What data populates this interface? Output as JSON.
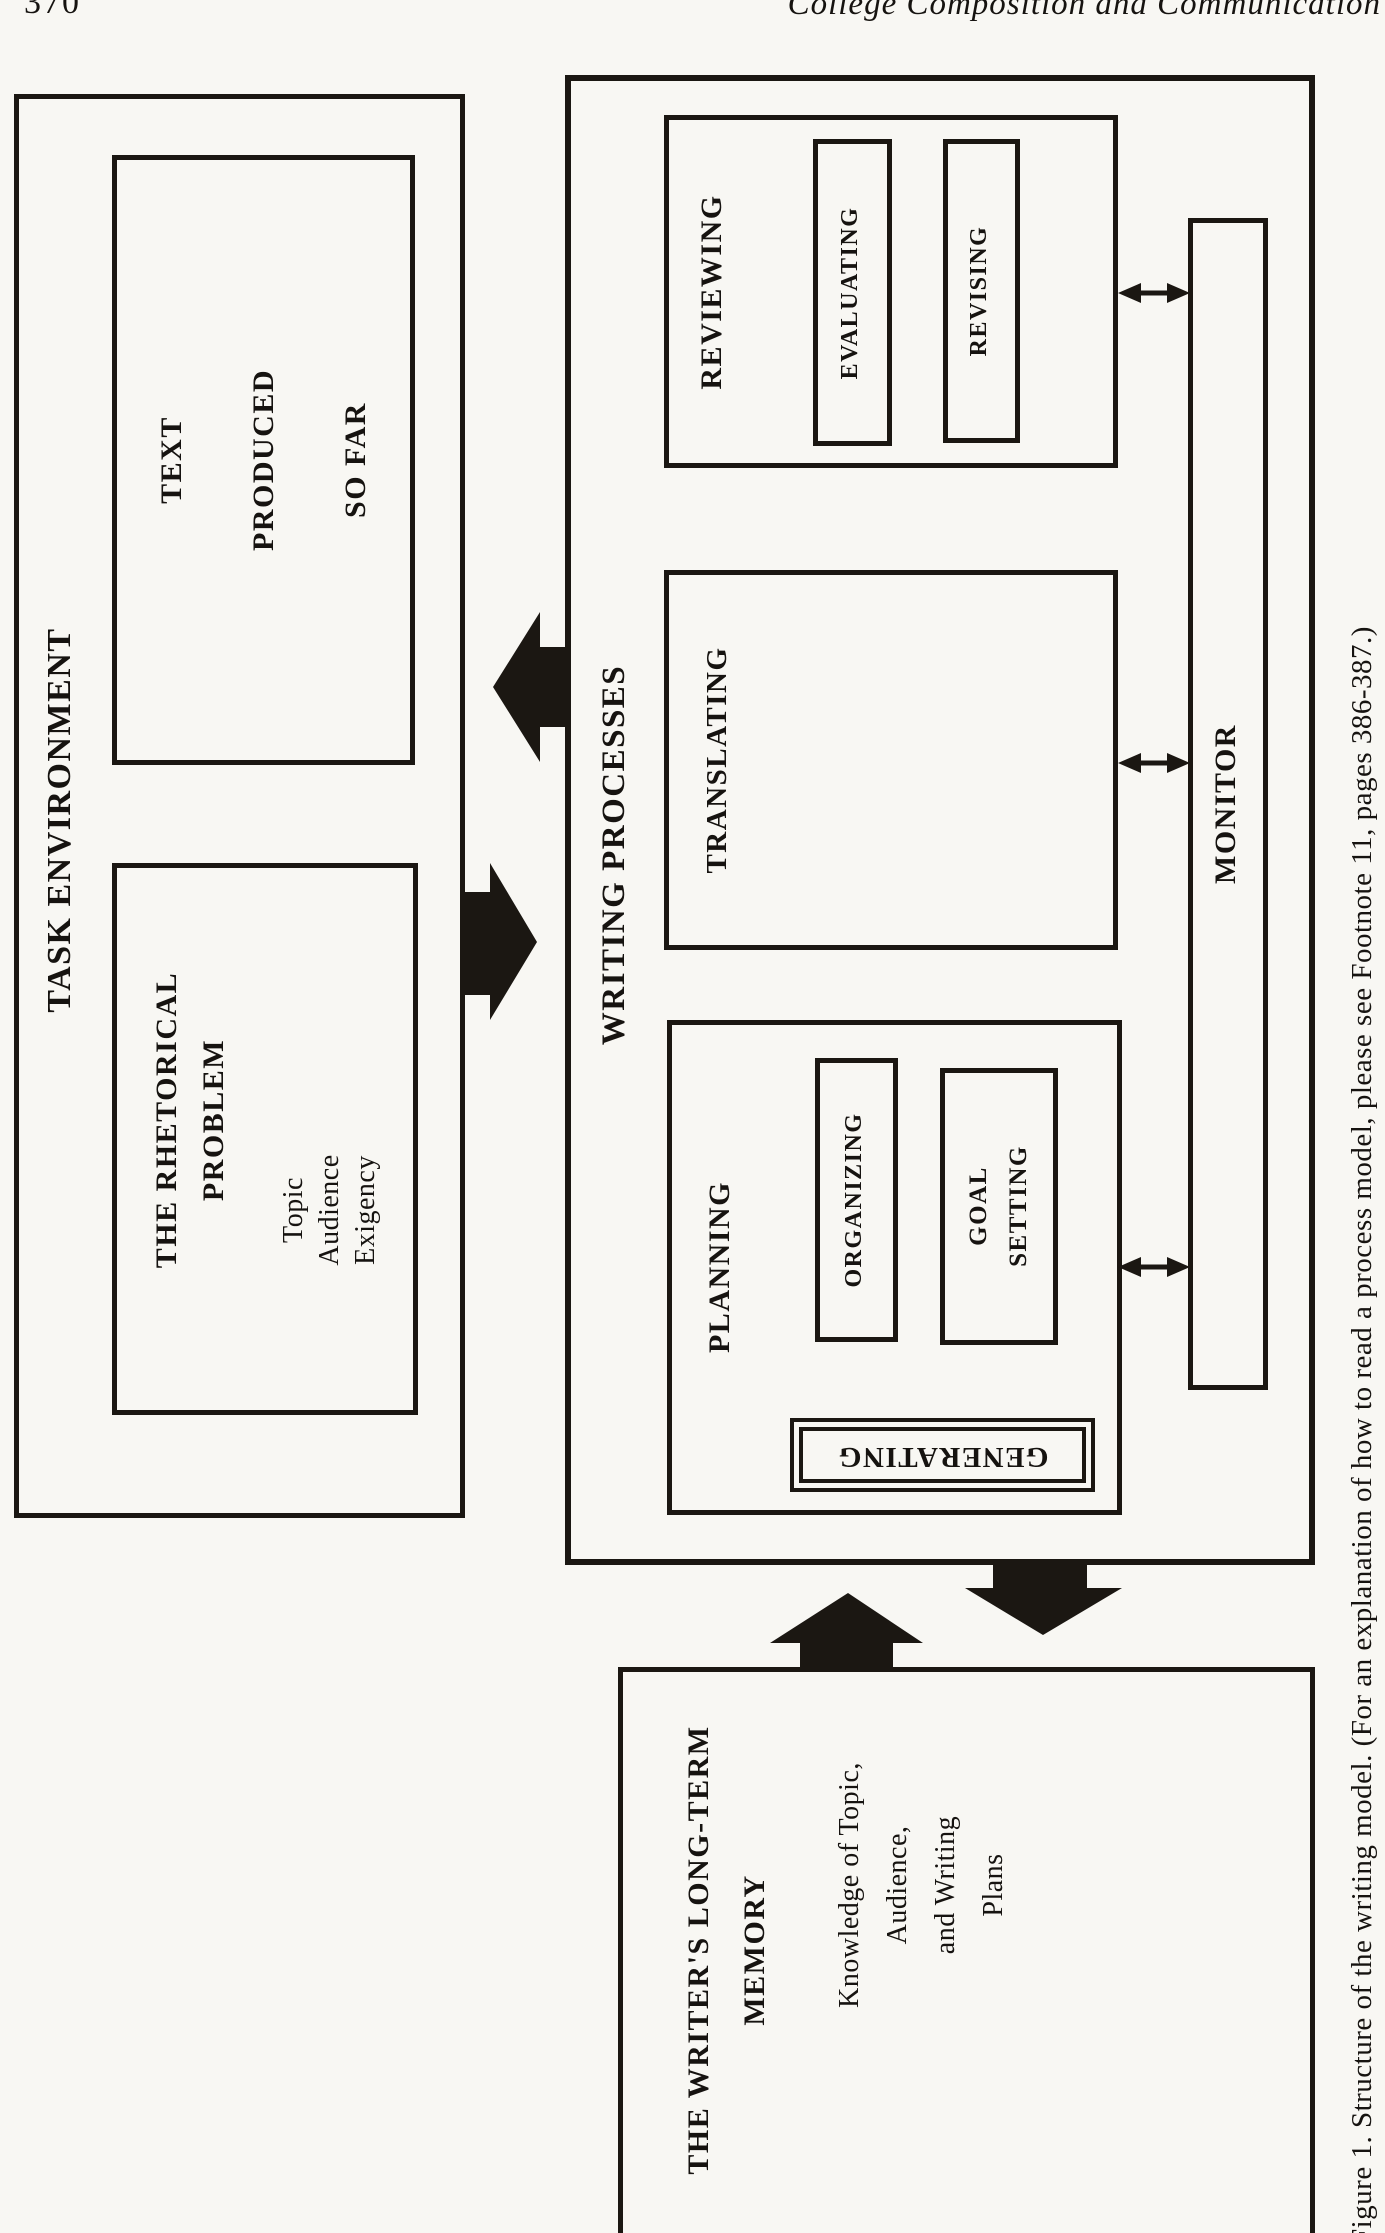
{
  "page": {
    "number": "370",
    "running_head": "College Composition and Communication"
  },
  "figure": {
    "caption": "Figure 1. Structure of the writing model. (For an explanation of how to read a process model, please see Footnote 11, pages 386-387.)",
    "task_environment": {
      "label": "TASK ENVIRONMENT",
      "rhetorical_problem": {
        "heading": "THE RHETORICAL\nPROBLEM",
        "items": "Topic\nAudience\nExigency"
      },
      "text_produced": {
        "lines": "TEXT\nPRODUCED\nSO FAR"
      }
    },
    "writing_processes": {
      "label": "WRITING PROCESSES",
      "planning": {
        "label": "PLANNING",
        "generating": "GENERATING",
        "organizing": "ORGANIZING",
        "goal_setting": "GOAL\nSETTING"
      },
      "translating": {
        "label": "TRANSLATING"
      },
      "reviewing": {
        "label": "REVIEWING",
        "evaluating": "EVALUATING",
        "revising": "REVISING"
      },
      "monitor": {
        "label": "MONITOR"
      }
    },
    "long_term_memory": {
      "heading": "THE WRITER'S LONG-TERM\nMEMORY",
      "body": "Knowledge of Topic,\nAudience,\nand Writing\nPlans"
    },
    "arrows": [
      {
        "name": "writing-to-task-block-arrow",
        "direction": "left"
      },
      {
        "name": "task-to-writing-block-arrow",
        "direction": "right"
      },
      {
        "name": "memory-to-writing-block-arrow",
        "direction": "up"
      },
      {
        "name": "writing-to-memory-block-arrow",
        "direction": "down"
      },
      {
        "name": "reviewing-monitor-double-arrow",
        "direction": "both"
      },
      {
        "name": "translating-monitor-double-arrow",
        "direction": "both"
      },
      {
        "name": "planning-monitor-double-arrow",
        "direction": "both"
      }
    ],
    "ink_color": "#1b1712"
  }
}
